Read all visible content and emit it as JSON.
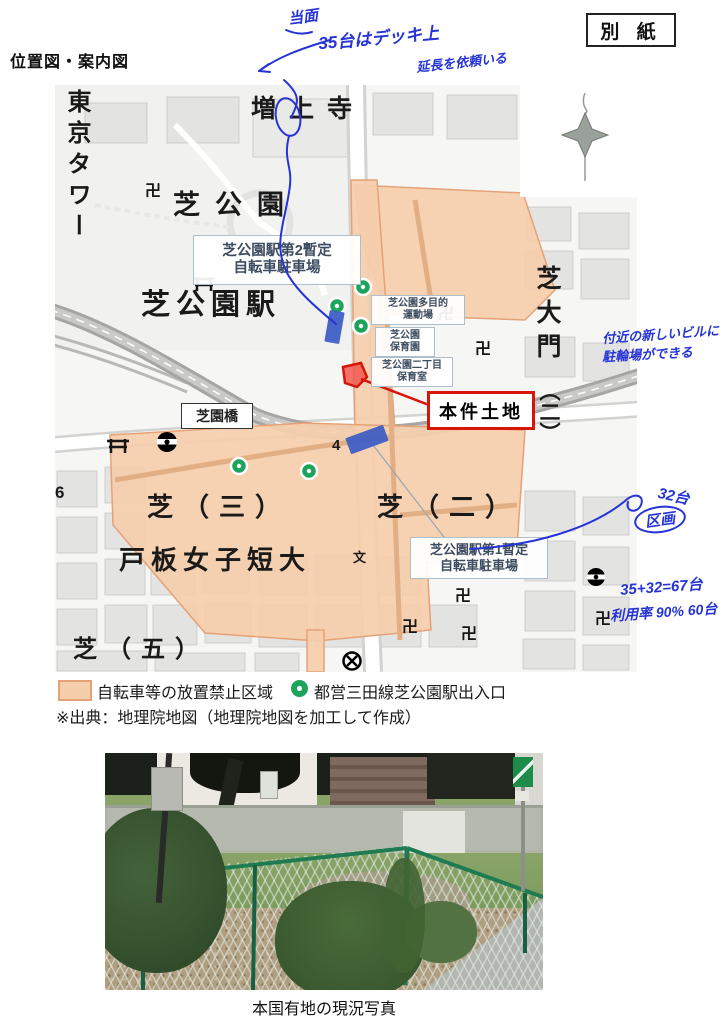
{
  "page": {
    "besshi": "別 紙",
    "title": "位置図・案内図"
  },
  "handwriting": {
    "top1": "当面",
    "top2": "35台はデッキ上",
    "top3": "延長を依頼いる",
    "right1": "付近の新しいビルに",
    "right2": "駐輪場ができる",
    "units": "32台",
    "kukaku": "区画",
    "calc": "35+32=67台",
    "usage": "利用率 90% 60台"
  },
  "map": {
    "labels": {
      "tokyo_tower": "東京タワー",
      "zojoji": "増上寺",
      "shiba_park": "芝公園",
      "shibakoen_station": "芝公園駅",
      "shiba_daimon": "芝大門",
      "daimon_chome": "（二）",
      "shibazono_bridge": "芝園橋",
      "shiba_3": "芝（三）",
      "shiba_2": "芝（二）",
      "toita_college": "戸板女子短大",
      "shiba_5": "芝（五）",
      "block_6": "6",
      "block_4": "4",
      "school_mark": "文",
      "temple_mark": "卍"
    },
    "callouts": {
      "parking2_l1": "芝公園駅第2暫定",
      "parking2_l2": "自転車駐車場",
      "playground_l1": "芝公園多目的",
      "playground_l2": "運動場",
      "nursery_l1": "芝公園",
      "nursery_l2": "保育園",
      "nursery2_l1": "芝公園二丁目",
      "nursery2_l2": "保育室",
      "parking1_l1": "芝公園駅第1暫定",
      "parking1_l2": "自転車駐車場",
      "subject_site": "本件土地"
    }
  },
  "legend": {
    "zone": "自転車等の放置禁止区域",
    "exit": "都営三田線芝公園駅出入口",
    "source": "※出典：地理院地図（地理院地図を加工して作成）"
  },
  "photo": {
    "caption": "本国有地の現況写真"
  },
  "colors": {
    "zone_fill": "#F5CEAC",
    "zone_border": "#E6A277",
    "exit_green": "#1CA45C",
    "parking_blue": "#3B5BC4",
    "site_red": "#D6150B",
    "ink_blue": "#2634D6"
  }
}
